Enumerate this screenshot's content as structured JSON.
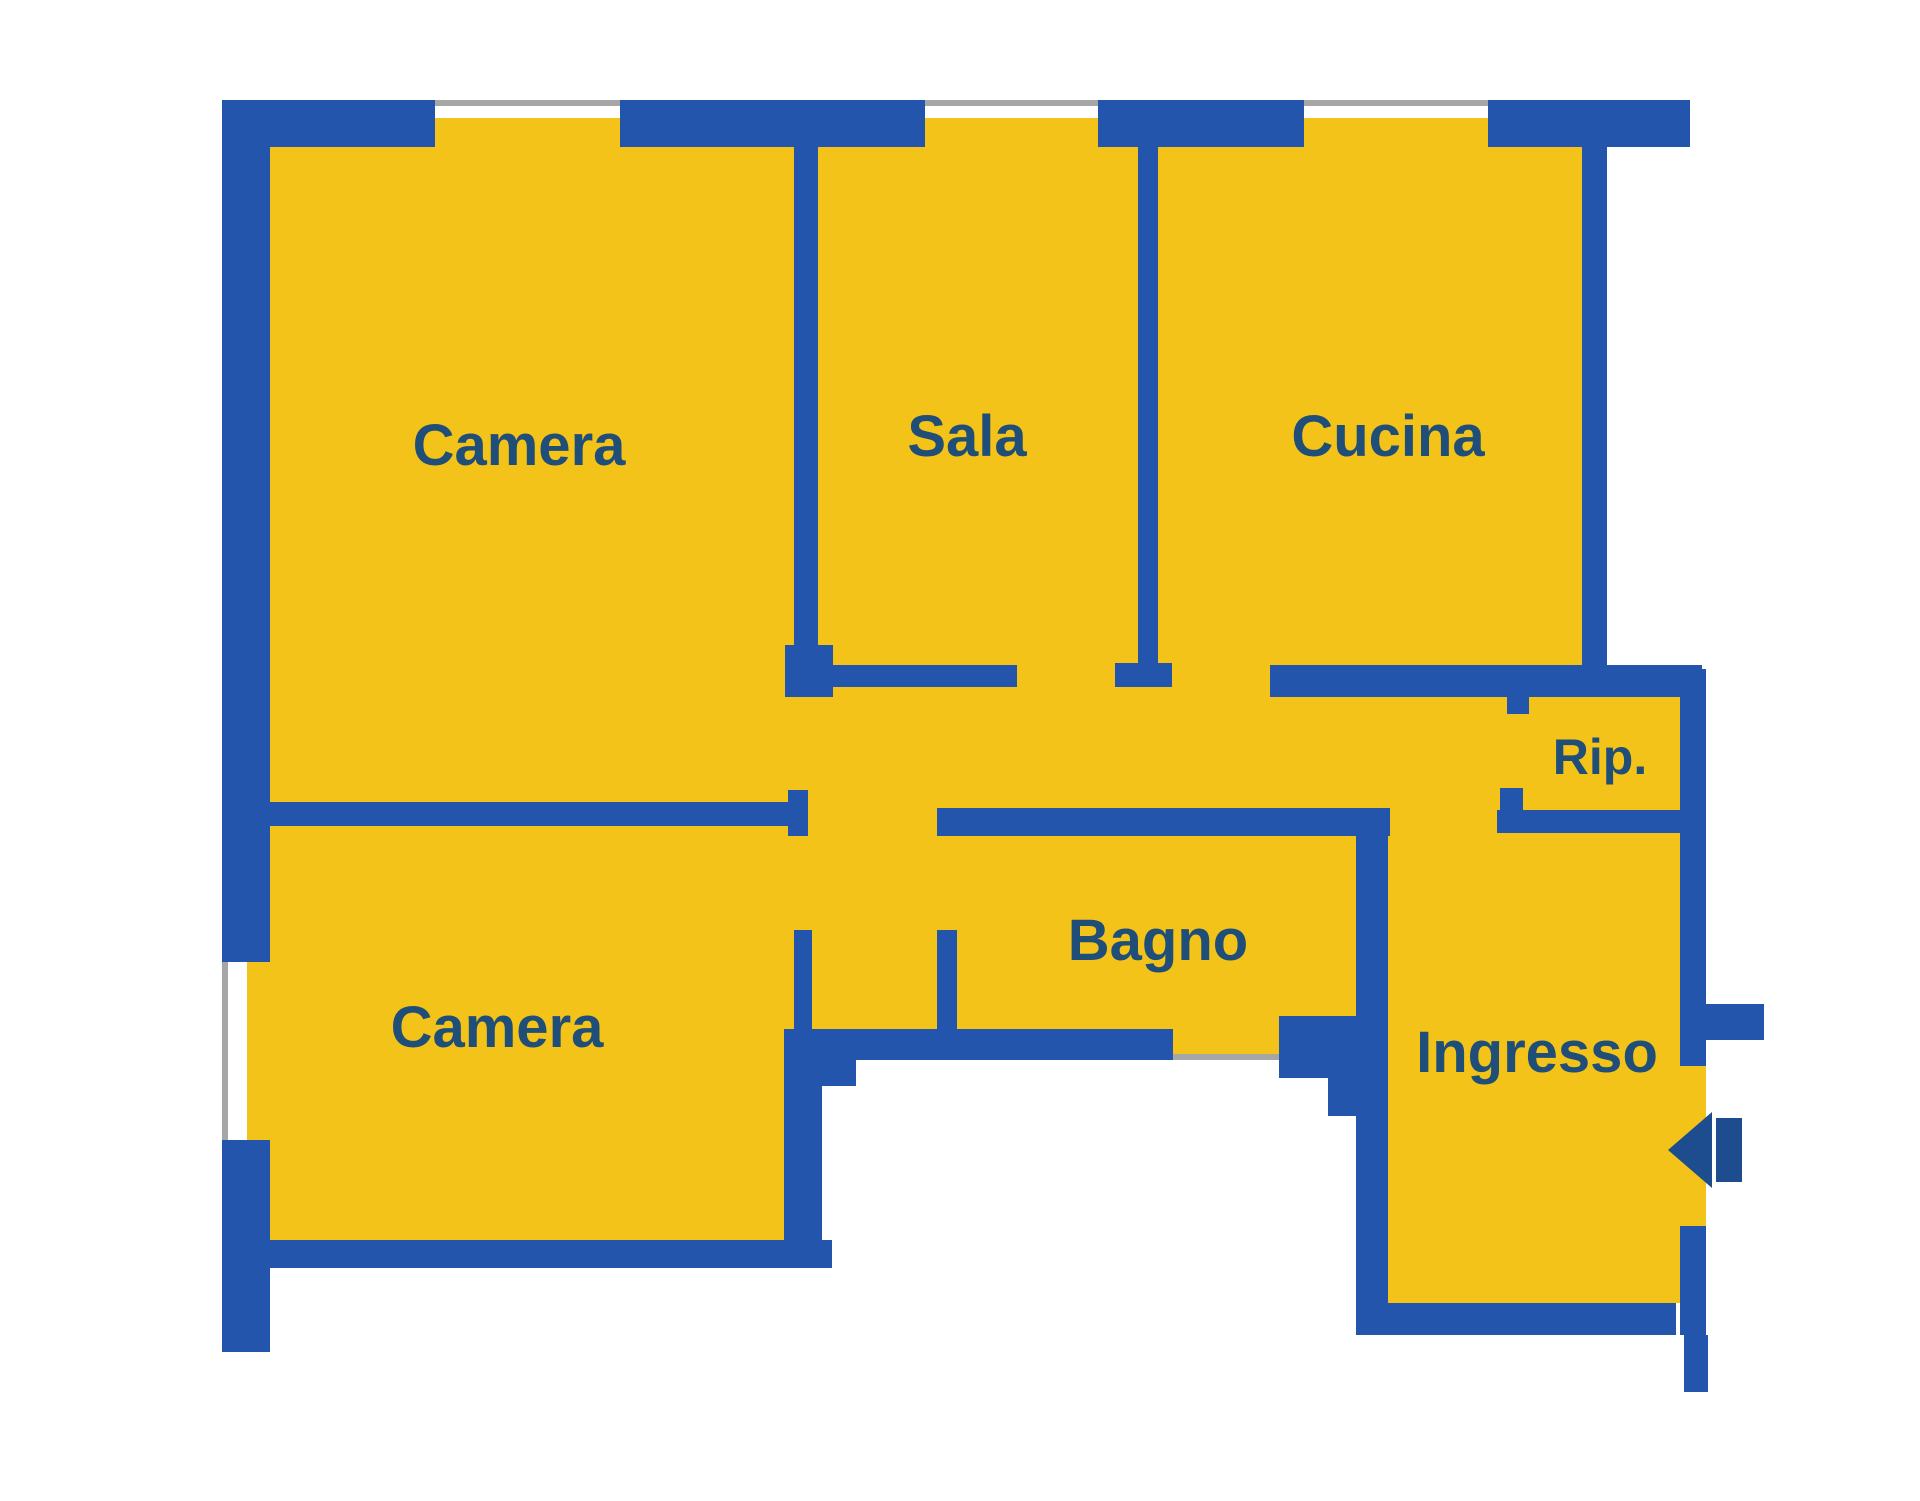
{
  "floorplan": {
    "title": "Apartment floor plan",
    "rooms": {
      "camera1": {
        "label": "Camera"
      },
      "sala": {
        "label": "Sala"
      },
      "cucina": {
        "label": "Cucina"
      },
      "rip": {
        "label": "Rip."
      },
      "bagno": {
        "label": "Bagno"
      },
      "camera2": {
        "label": "Camera"
      },
      "ingresso": {
        "label": "Ingresso"
      }
    },
    "colors": {
      "floor": "#F4C319",
      "wall": "#2355AD",
      "label_text": "#1F4E79",
      "window_line": "#A6A6A6",
      "door_arrow": "#1D4C8F",
      "background": "#FFFFFF"
    }
  }
}
